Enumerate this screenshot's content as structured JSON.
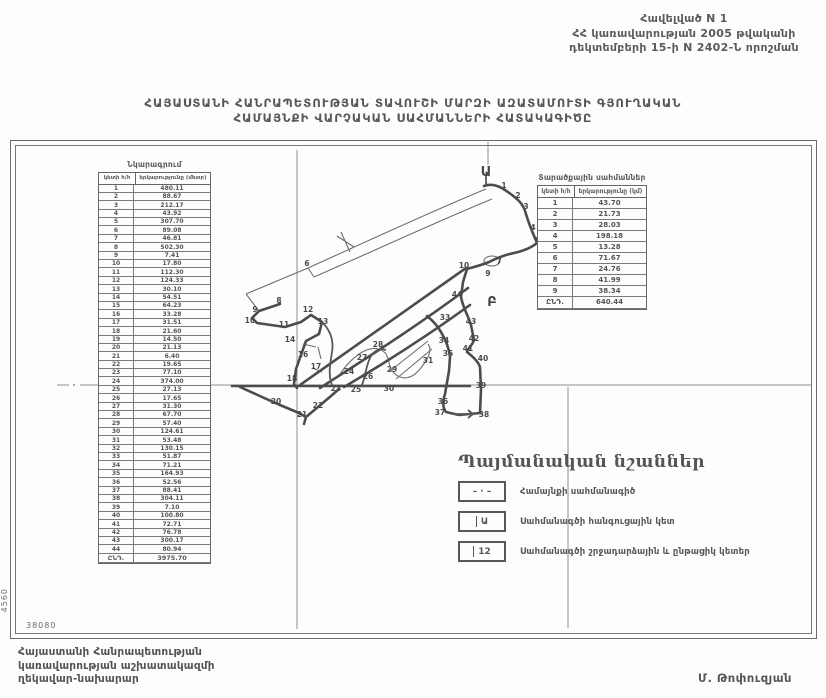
{
  "header_note": {
    "line1": "Հավելված N 1",
    "line2": "ՀՀ կառավարության 2005 թվականի",
    "line3": "դեկտեմբերի 15-ի N 2402-Ն որոշման"
  },
  "title": {
    "line1": "ՀԱՅԱՍՏԱՆԻ ՀԱՆՐԱՊԵՏՈՒԹՅԱՆ ՏԱՎՈՒՇԻ ՄԱՐԶԻ ԱԶԱՏԱՄՈՒՏԻ ԳՅՈՒՂԱԿԱՆ",
    "line2": "ՀԱՄԱՅՆՔԻ ՎԱՐՉԱԿԱՆ  ՍԱՀՄԱՆՆԵՐԻ  ՀԱՏԱԿԱԳԻԾԸ"
  },
  "left_table": {
    "title": "Նկարագրում",
    "col1": "կետի հ/հ",
    "col2": "երկարությունը (մետր)",
    "rows": [
      [
        "1",
        "480.11"
      ],
      [
        "2",
        "88.67"
      ],
      [
        "3",
        "212.17"
      ],
      [
        "4",
        "43.92"
      ],
      [
        "5",
        "307.70"
      ],
      [
        "6",
        "89.08"
      ],
      [
        "7",
        "46.81"
      ],
      [
        "8",
        "502.30"
      ],
      [
        "9",
        "7.41"
      ],
      [
        "10",
        "17.80"
      ],
      [
        "11",
        "112.30"
      ],
      [
        "12",
        "124.33"
      ],
      [
        "13",
        "30.10"
      ],
      [
        "14",
        "54.51"
      ],
      [
        "15",
        "64.23"
      ],
      [
        "16",
        "33.28"
      ],
      [
        "17",
        "31.51"
      ],
      [
        "18",
        "21.60"
      ],
      [
        "19",
        "14.50"
      ],
      [
        "20",
        "21.13"
      ],
      [
        "21",
        "6.40"
      ],
      [
        "22",
        "19.65"
      ],
      [
        "23",
        "77.10"
      ],
      [
        "24",
        "374.00"
      ],
      [
        "25",
        "27.13"
      ],
      [
        "26",
        "17.65"
      ],
      [
        "27",
        "31.30"
      ],
      [
        "28",
        "67.70"
      ],
      [
        "29",
        "57.40"
      ],
      [
        "30",
        "124.61"
      ],
      [
        "31",
        "53.48"
      ],
      [
        "32",
        "130.15"
      ],
      [
        "33",
        "51.87"
      ],
      [
        "34",
        "71.21"
      ],
      [
        "35",
        "164.93"
      ],
      [
        "36",
        "52.56"
      ],
      [
        "37",
        "88.41"
      ],
      [
        "38",
        "304.11"
      ],
      [
        "39",
        "7.10"
      ],
      [
        "40",
        "100.80"
      ],
      [
        "41",
        "72.71"
      ],
      [
        "42",
        "76.78"
      ],
      [
        "43",
        "300.17"
      ],
      [
        "44",
        "80.94"
      ]
    ],
    "total_label": "ԸՆԴ.",
    "total_value": "3975.70"
  },
  "right_table": {
    "title": "Տարածքային սահմաններ",
    "col1": "կետի հ/հ",
    "col2": "երկարությունը (կմ)",
    "rows": [
      [
        "1",
        "43.70"
      ],
      [
        "2",
        "21.73"
      ],
      [
        "3",
        "28.03"
      ],
      [
        "4",
        "198.18"
      ],
      [
        "5",
        "13.28"
      ],
      [
        "6",
        "71.67"
      ],
      [
        "7",
        "24.76"
      ],
      [
        "8",
        "41.99"
      ],
      [
        "9",
        "38.34"
      ]
    ],
    "total_label": "ԸՆԴ.",
    "total_value": "640.44"
  },
  "legend": {
    "title": "Պայմանական նշաններ",
    "items": [
      {
        "symbol": "– · –",
        "label": "Համայնքի սահմանագիծ"
      },
      {
        "symbol": "Ա",
        "label": "Սահմանագծի հանգուցային կետ"
      },
      {
        "symbol": "12",
        "label": "Սահմանագծի շրջադարձային և ընթացիկ կետեր"
      }
    ]
  },
  "footer": {
    "left_line1": "Հայաստանի Հանրապետության",
    "left_line2": "կառավարության աշխատակազմի",
    "left_line3": "ղեկավար-նախարար",
    "signature": "Մ. Թոփուզյան"
  },
  "map": {
    "node_a": "Ա",
    "node_b": "Բ",
    "corner_vertical": "4560",
    "corner_horizontal": "38080",
    "points": [
      {
        "n": "1",
        "x": 504,
        "y": 188
      },
      {
        "n": "2",
        "x": 518,
        "y": 198
      },
      {
        "n": "3",
        "x": 526,
        "y": 209
      },
      {
        "n": "4",
        "x": 533,
        "y": 230
      },
      {
        "n": "5",
        "x": 538,
        "y": 243
      },
      {
        "n": "6",
        "x": 307,
        "y": 266
      },
      {
        "n": "7",
        "x": 499,
        "y": 264
      },
      {
        "n": "9",
        "x": 488,
        "y": 276
      },
      {
        "n": "10",
        "x": 464,
        "y": 268
      },
      {
        "n": "8",
        "x": 279,
        "y": 303
      },
      {
        "n": "9",
        "x": 255,
        "y": 312
      },
      {
        "n": "10",
        "x": 250,
        "y": 323
      },
      {
        "n": "11",
        "x": 284,
        "y": 327
      },
      {
        "n": "12",
        "x": 308,
        "y": 312
      },
      {
        "n": "13",
        "x": 323,
        "y": 324
      },
      {
        "n": "14",
        "x": 290,
        "y": 342
      },
      {
        "n": "16",
        "x": 303,
        "y": 357
      },
      {
        "n": "17",
        "x": 316,
        "y": 369
      },
      {
        "n": "18",
        "x": 292,
        "y": 381
      },
      {
        "n": "20",
        "x": 276,
        "y": 404
      },
      {
        "n": "21",
        "x": 302,
        "y": 417
      },
      {
        "n": "22",
        "x": 318,
        "y": 408
      },
      {
        "n": "23",
        "x": 336,
        "y": 391
      },
      {
        "n": "24",
        "x": 349,
        "y": 374
      },
      {
        "n": "25",
        "x": 356,
        "y": 392
      },
      {
        "n": "26",
        "x": 368,
        "y": 379
      },
      {
        "n": "27",
        "x": 362,
        "y": 360
      },
      {
        "n": "28",
        "x": 378,
        "y": 347
      },
      {
        "n": "29",
        "x": 392,
        "y": 372
      },
      {
        "n": "30",
        "x": 389,
        "y": 391
      },
      {
        "n": "31",
        "x": 428,
        "y": 363
      },
      {
        "n": "33",
        "x": 445,
        "y": 320
      },
      {
        "n": "34",
        "x": 444,
        "y": 343
      },
      {
        "n": "35",
        "x": 448,
        "y": 356
      },
      {
        "n": "36",
        "x": 443,
        "y": 404
      },
      {
        "n": "37",
        "x": 440,
        "y": 415
      },
      {
        "n": "38",
        "x": 484,
        "y": 417
      },
      {
        "n": "39",
        "x": 481,
        "y": 388
      },
      {
        "n": "40",
        "x": 483,
        "y": 361
      },
      {
        "n": "41",
        "x": 468,
        "y": 351
      },
      {
        "n": "42",
        "x": 474,
        "y": 341
      },
      {
        "n": "43",
        "x": 471,
        "y": 324
      },
      {
        "n": "44",
        "x": 457,
        "y": 297
      }
    ]
  }
}
